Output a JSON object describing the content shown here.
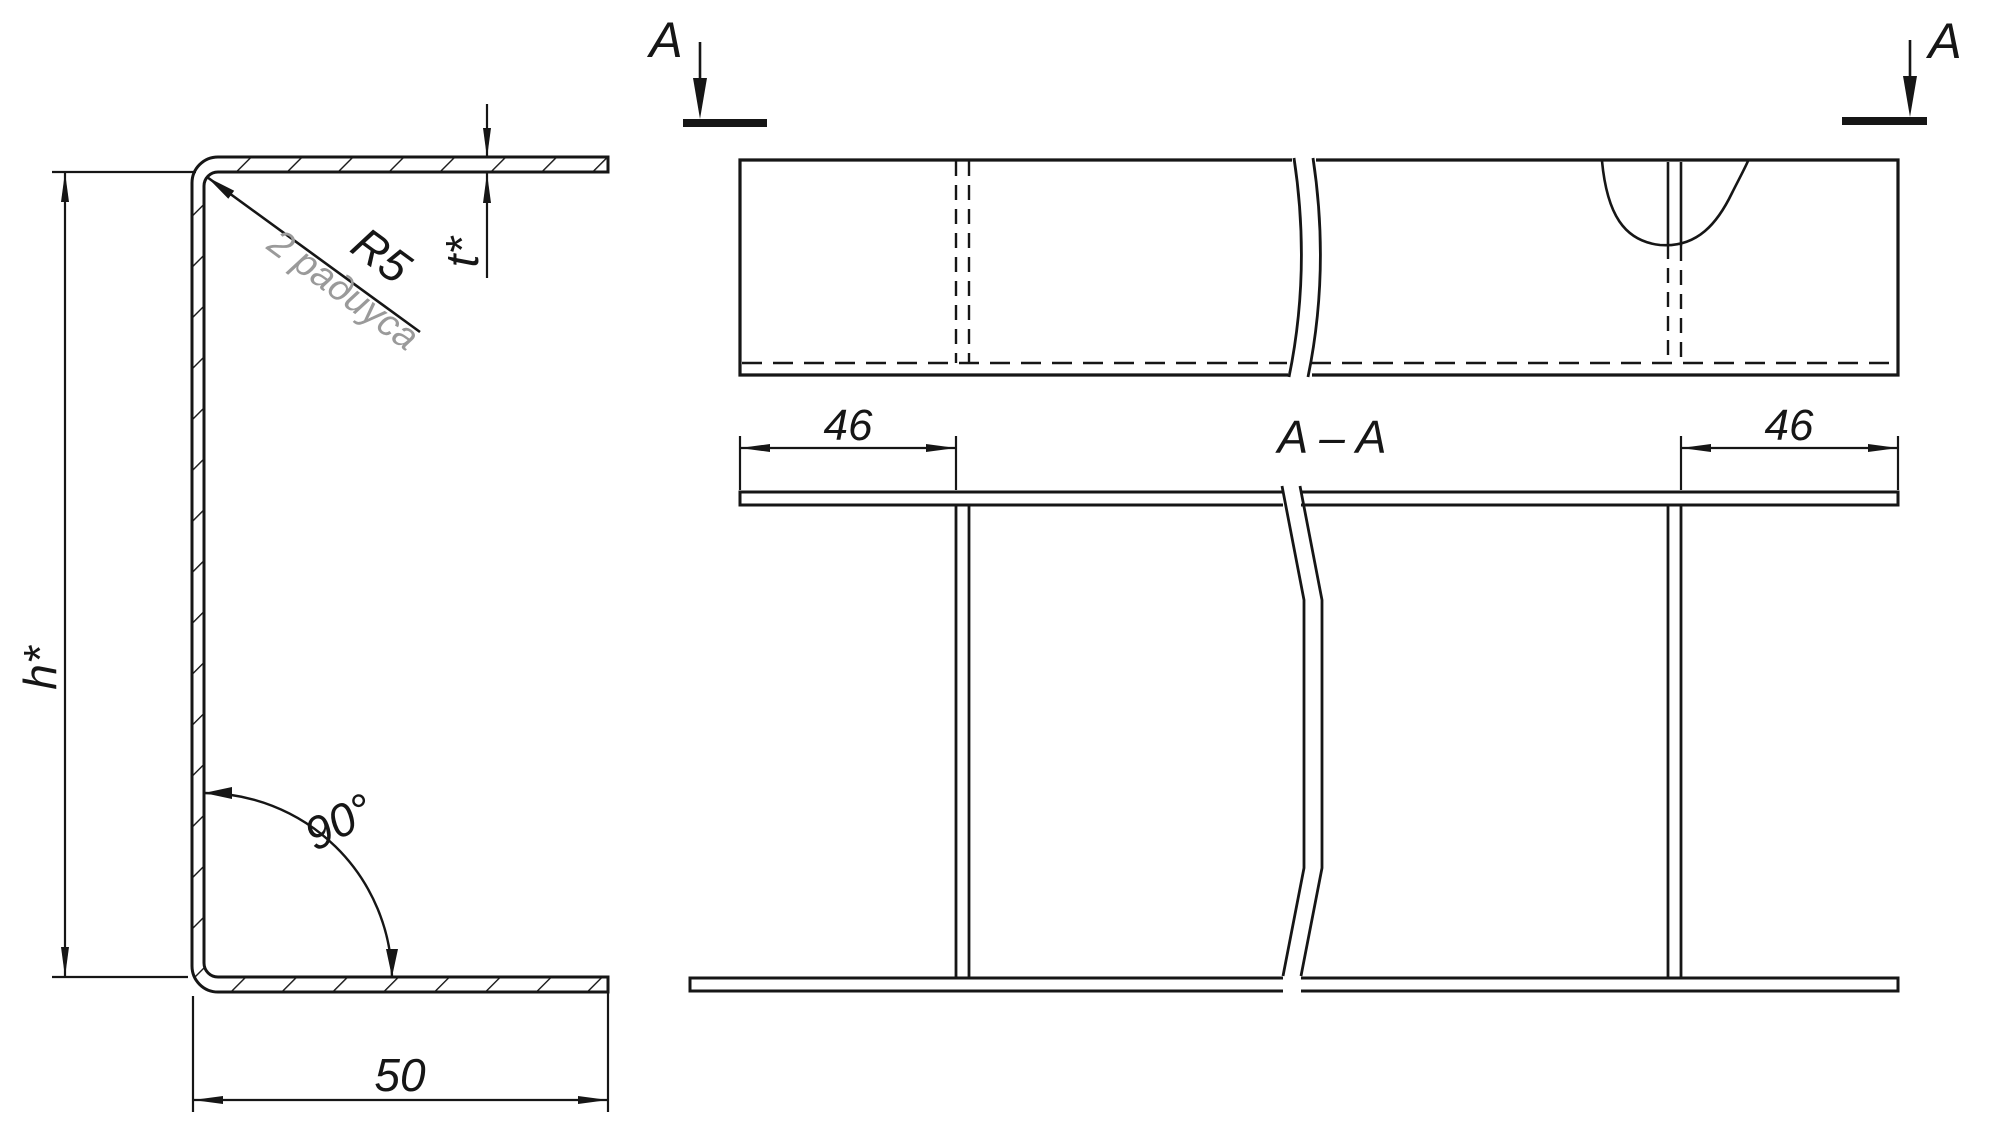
{
  "drawing": {
    "kind": "engineering-drawing-bent-channel-profile",
    "colors": {
      "ink": "#161616",
      "note_ink": "#9a9a9a",
      "background": "#ffffff"
    },
    "cross_section_view": {
      "height_label": "h*",
      "thickness_label": "t*",
      "radius_label": "R5",
      "radius_note": "2 радиуса",
      "angle_label": "90°",
      "flange_width_label": "50"
    },
    "plan_view": {
      "cut_letter_left": "A",
      "cut_letter_right": "A"
    },
    "section_view": {
      "title": "A – A",
      "rib_inset_left_label": "46",
      "rib_inset_right_label": "46"
    }
  }
}
